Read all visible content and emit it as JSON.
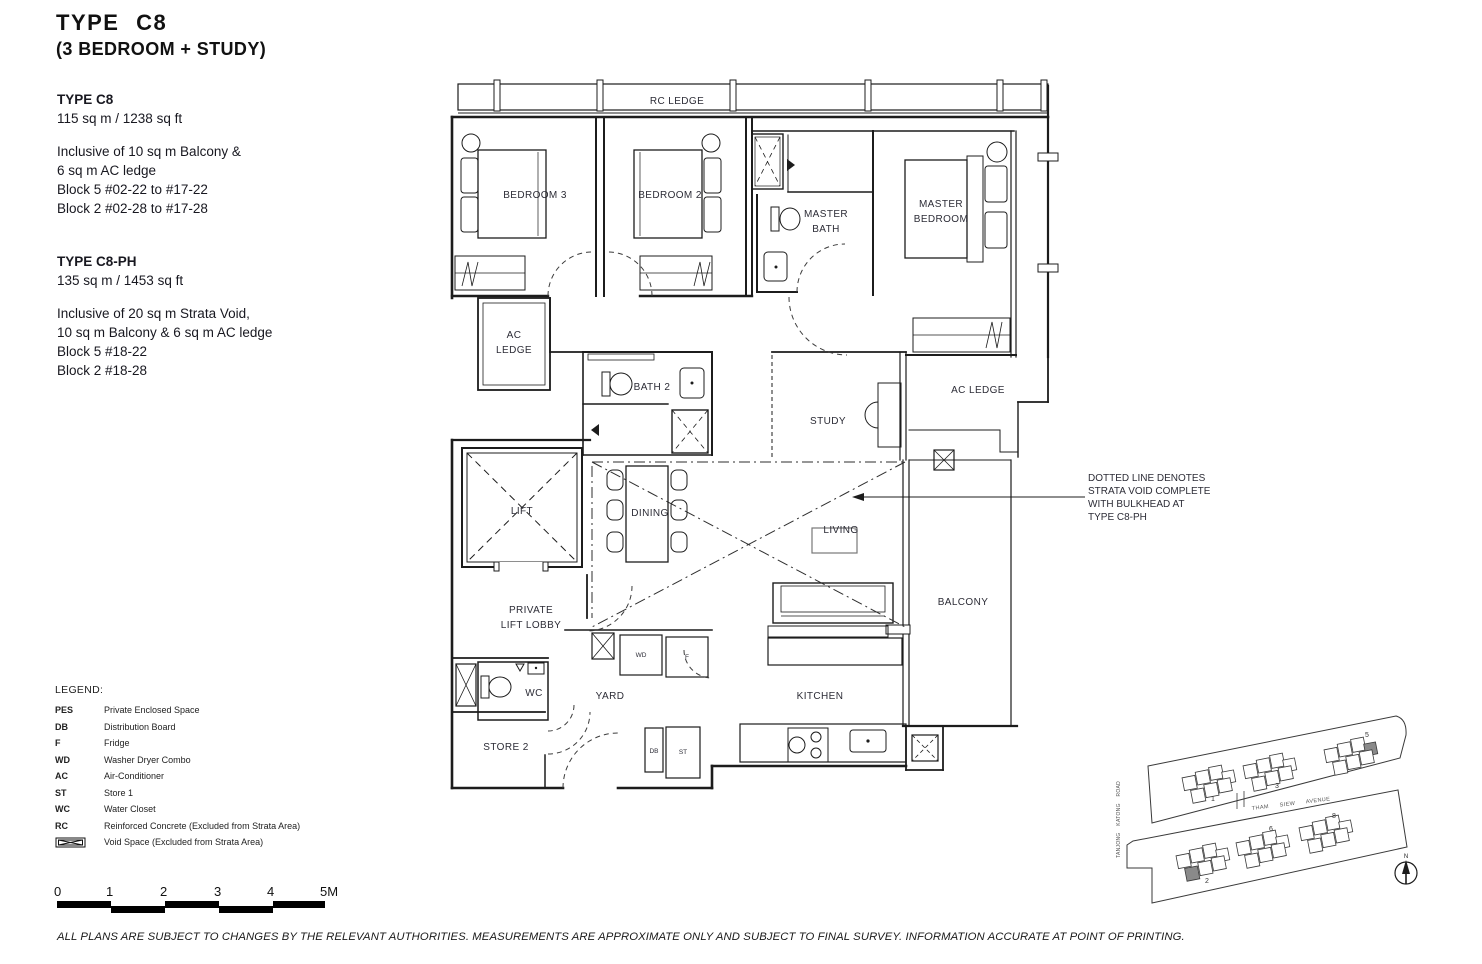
{
  "page": {
    "title": "TYPE C8",
    "subtitle": "(3 BEDROOM + STUDY)",
    "disclaimer": "ALL PLANS ARE SUBJECT TO CHANGES BY THE RELEVANT AUTHORITIES. MEASUREMENTS ARE APPROXIMATE ONLY AND SUBJECT TO FINAL SURVEY. INFORMATION ACCURATE AT POINT OF PRINTING."
  },
  "info_blocks": [
    {
      "heading": "TYPE C8",
      "area": "115 sq m / 1238 sq ft",
      "lines": [
        "Inclusive of 10 sq m Balcony &",
        "6 sq m AC ledge",
        "Block 5 #02-22 to #17-22",
        "Block 2 #02-28 to #17-28"
      ]
    },
    {
      "heading": "TYPE C8-PH",
      "area": "135 sq m / 1453 sq ft",
      "lines": [
        "Inclusive of 20 sq m Strata Void,",
        "10 sq m Balcony & 6 sq m AC ledge",
        "Block 5 #18-22",
        "Block 2 #18-28"
      ]
    }
  ],
  "legend": {
    "title": "LEGEND:",
    "items": [
      {
        "abbr": "PES",
        "desc": "Private Enclosed Space"
      },
      {
        "abbr": "DB",
        "desc": "Distribution Board"
      },
      {
        "abbr": "F",
        "desc": "Fridge"
      },
      {
        "abbr": "WD",
        "desc": "Washer Dryer Combo"
      },
      {
        "abbr": "AC",
        "desc": "Air-Conditioner"
      },
      {
        "abbr": "ST",
        "desc": "Store 1"
      },
      {
        "abbr": "WC",
        "desc": "Water Closet"
      },
      {
        "abbr": "RC",
        "desc": "Reinforced Concrete (Excluded from Strata Area)"
      },
      {
        "abbr": "",
        "desc": "Void Space (Excluded from Strata Area)"
      }
    ]
  },
  "floorplan": {
    "rooms": {
      "rc_ledge": "RC LEDGE",
      "bedroom3": "BEDROOM 3",
      "bedroom2": "BEDROOM 2",
      "master_bath": [
        "MASTER",
        "BATH"
      ],
      "master_bedroom": [
        "MASTER",
        "BEDROOM"
      ],
      "ac_ledge_left": [
        "AC",
        "LEDGE"
      ],
      "bath2": "BATH 2",
      "study": "STUDY",
      "ac_ledge_right": "AC LEDGE",
      "lift": "LIFT",
      "dining": "DINING",
      "living": "LIVING",
      "balcony": "BALCONY",
      "private_lift_lobby": [
        "PRIVATE",
        "LIFT LOBBY"
      ],
      "wc": "WC",
      "yard": "YARD",
      "kitchen": "KITCHEN",
      "store2": "STORE 2"
    },
    "appliances": {
      "wd": "WD",
      "f": "F",
      "db": "DB",
      "st": "ST"
    },
    "annotation": [
      "DOTTED LINE DENOTES",
      "STRATA VOID COMPLETE",
      "WITH BULKHEAD AT",
      "TYPE C8-PH"
    ]
  },
  "scale_bar": {
    "labels": [
      "0",
      "1",
      "2",
      "3",
      "4",
      "5M"
    ]
  },
  "site_plan": {
    "road_main": "THAM SIEW AVENUE",
    "road_side": "TANJONG KATONG ROAD",
    "block_labels": [
      "1",
      "3",
      "5",
      "2",
      "6",
      "8"
    ],
    "compass": "N"
  },
  "colors": {
    "line": "#1c1c1c",
    "label": "#2c2c36",
    "shaded_unit": "#8a8a8a"
  }
}
